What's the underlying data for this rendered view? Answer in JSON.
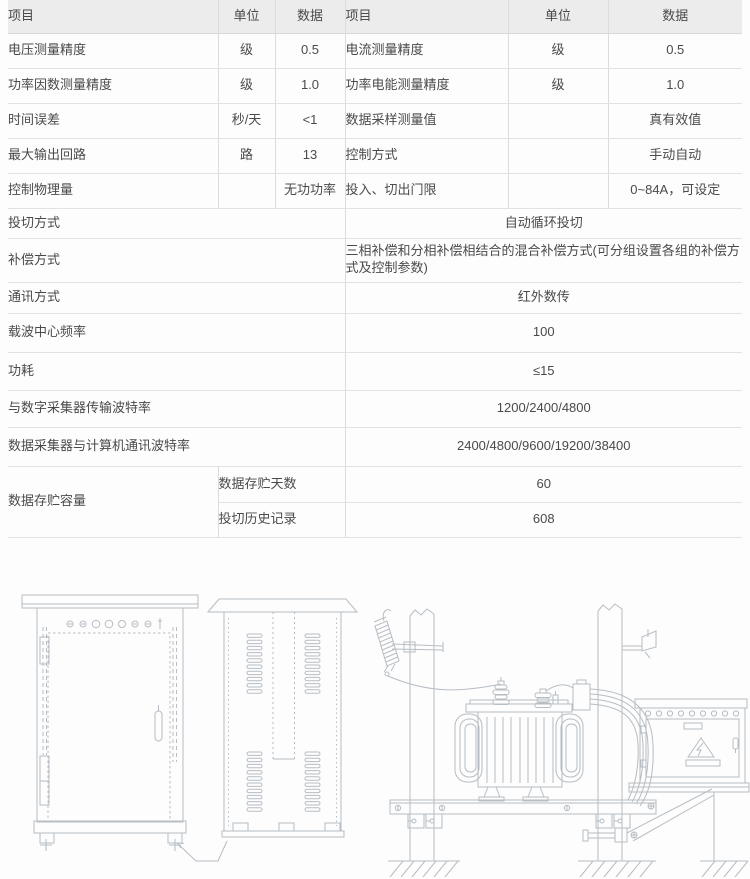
{
  "colors": {
    "header_bg": "#ececec",
    "border": "#dcdcdc",
    "text": "#4a4a4a",
    "line_art": "#b7bdc3"
  },
  "spec_table": {
    "headers": [
      "项目",
      "单位",
      "数据",
      "项目",
      "单位",
      "数据"
    ],
    "rows5": [
      {
        "l_item": "电压测量精度",
        "l_unit": "级",
        "l_val": "0.5",
        "r_item": "电流测量精度",
        "r_unit": "级",
        "r_val": "0.5"
      },
      {
        "l_item": "功率因数测量精度",
        "l_unit": "级",
        "l_val": "1.0",
        "r_item": "功率电能测量精度",
        "r_unit": "级",
        "r_val": "1.0"
      },
      {
        "l_item": "时间误差",
        "l_unit": "秒/天",
        "l_val": "<1",
        "r_item": "数据采样测量值",
        "r_unit": "",
        "r_val": "真有效值"
      },
      {
        "l_item": "最大输出回路",
        "l_unit": "路",
        "l_val": "13",
        "r_item": "控制方式",
        "r_unit": "",
        "r_val": "手动自动"
      },
      {
        "l_item": "控制物理量",
        "l_unit": "",
        "l_val": "无功功率",
        "r_item": "投入、切出门限",
        "r_unit": "",
        "r_val": "0~84A，可设定"
      }
    ],
    "rows_full": [
      {
        "item": "投切方式",
        "val": "自动循环投切"
      },
      {
        "item": "补偿方式",
        "val": "三相补偿和分相补偿相结合的混合补偿方式(可分组设置各组的补偿方式及控制参数)"
      },
      {
        "item": "通讯方式",
        "val": "红外数传"
      },
      {
        "item": "载波中心频率",
        "val": "100"
      },
      {
        "item": "功耗",
        "val": "≤15"
      },
      {
        "item": "与数字采集器传输波特率",
        "val": "1200/2400/4800"
      },
      {
        "item": "数据采集器与计算机通讯波特率",
        "val": "2400/4800/9600/19200/38400"
      }
    ],
    "storage": {
      "item": "数据存贮容量",
      "sub_rows": [
        {
          "label": "数据存贮天数",
          "val": "60"
        },
        {
          "label": "投切历史记录",
          "val": "608"
        }
      ]
    }
  },
  "drawings": {
    "left": "capacitor-cabinet-front-view",
    "middle": "capacitor-cabinet-side-view",
    "right": "pole-mounted-transformer-with-compensation-box",
    "warning_icon": "lightning-warning-triangle-icon"
  }
}
